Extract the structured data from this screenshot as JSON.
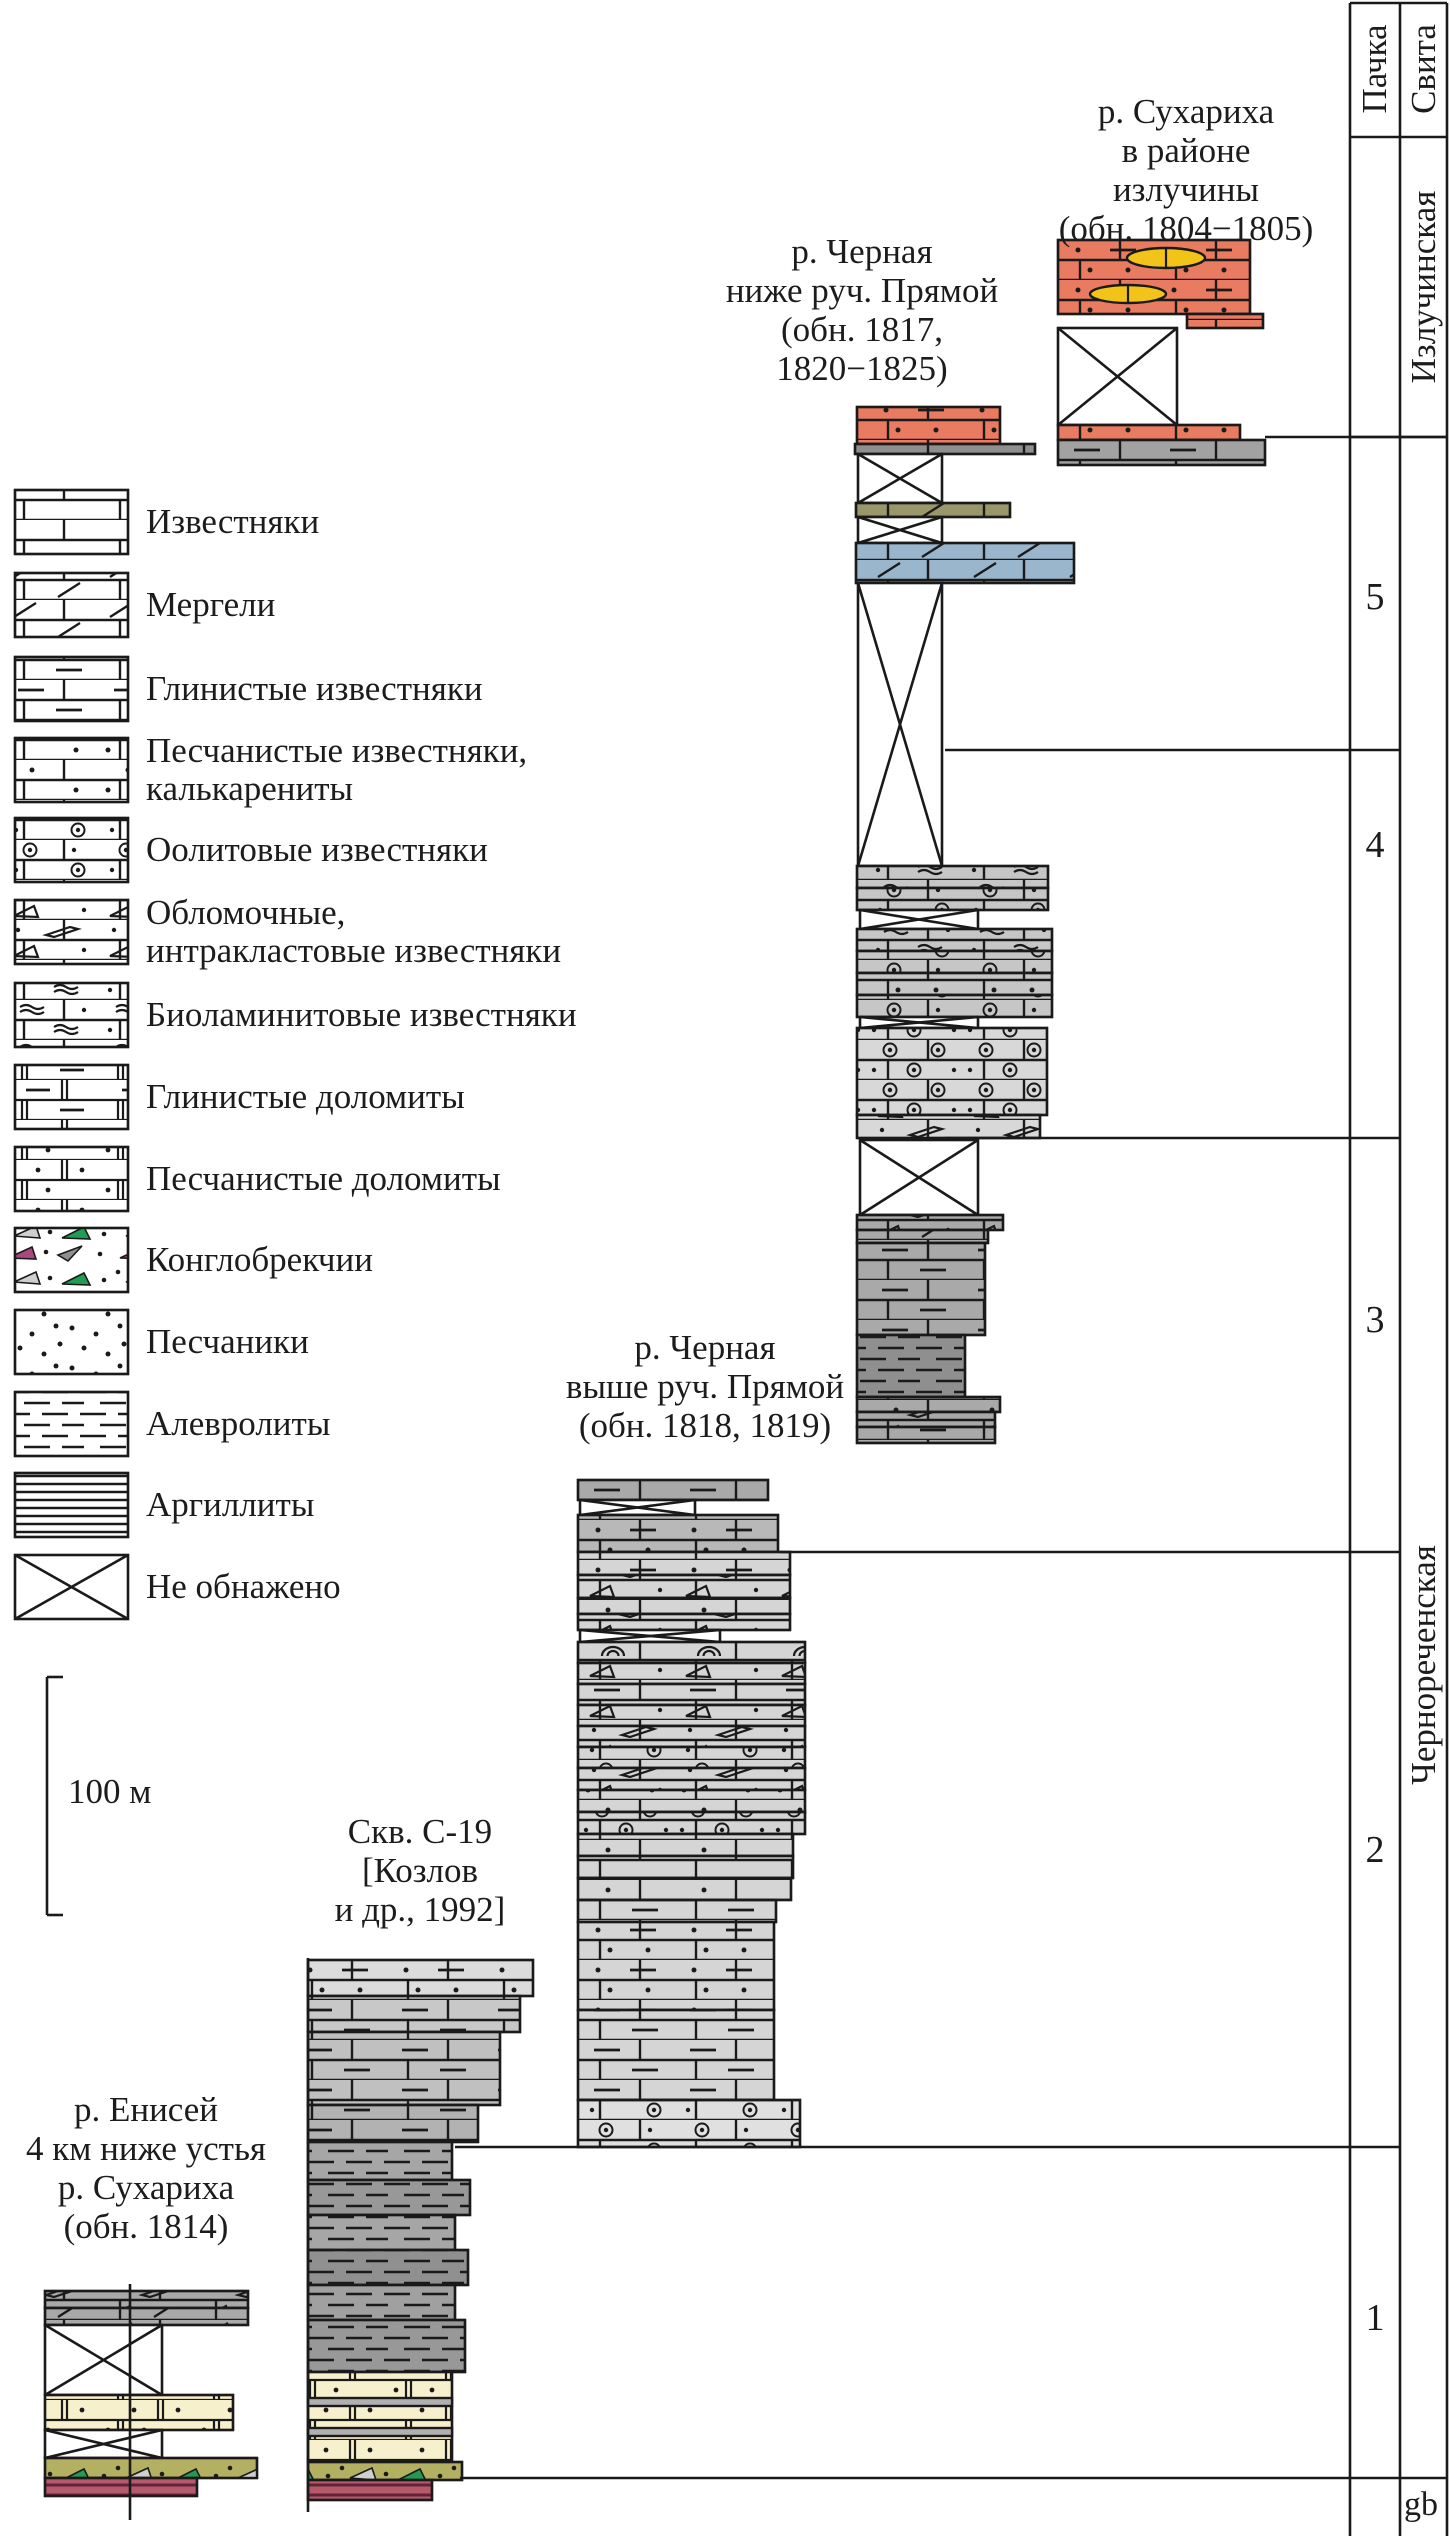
{
  "header": {
    "pachka": "Пачка",
    "svita": "Свита"
  },
  "formations": [
    {
      "name": "Излучинская",
      "cx": 1424,
      "cy": 287
    },
    {
      "name": "Чернореченская",
      "cx": 1424,
      "cy": 1665
    }
  ],
  "members": [
    {
      "label": "5",
      "cx": 1375,
      "cy": 597
    },
    {
      "label": "4",
      "cx": 1375,
      "cy": 845
    },
    {
      "label": "3",
      "cx": 1375,
      "cy": 1320
    },
    {
      "label": "2",
      "cx": 1375,
      "cy": 1850
    },
    {
      "label": "1",
      "cx": 1375,
      "cy": 2318
    }
  ],
  "footer": {
    "gb": "gb",
    "x": 1404,
    "y": 2486
  },
  "scalebar": {
    "label": "100 м",
    "label_x": 68,
    "label_y": 1772
  },
  "columns": [
    {
      "id": "enisey",
      "label": "р. Енисей\n4 км ниже устья\nр. Сухариха\n(обн. 1814)",
      "label_cx": 146,
      "label_top": 2090,
      "units": [
        {
          "x": 45,
          "y": 2291,
          "w": 203,
          "h": 17,
          "fill": "#a9a9a9",
          "pat": "brick-intra"
        },
        {
          "x": 45,
          "y": 2308,
          "w": 203,
          "h": 17,
          "fill": "#a9a9a9",
          "pat": "marl"
        },
        {
          "x": 45,
          "y": 2325,
          "w": 117,
          "h": 70,
          "type": "cross"
        },
        {
          "x": 45,
          "y": 2395,
          "w": 188,
          "h": 35,
          "fill": "#f7f0cc",
          "pat": "dolomite-dots"
        },
        {
          "x": 45,
          "y": 2430,
          "w": 117,
          "h": 28,
          "type": "cross"
        },
        {
          "x": 45,
          "y": 2458,
          "w": 212,
          "h": 20,
          "fill": "#b3b062",
          "pat": "conglo"
        },
        {
          "x": 45,
          "y": 2478,
          "w": 152,
          "h": 18,
          "fill": "#b55a6b",
          "pat": "crimson-lam"
        }
      ]
    },
    {
      "id": "skv-c19",
      "label": "Скв. С-19\n[Козлов\nи др., 1992]",
      "label_cx": 420,
      "label_top": 1812,
      "units": [
        {
          "x": 308,
          "y": 1960,
          "w": 225,
          "h": 36,
          "fill": "#dcdcdc",
          "pat": "brick-dotdash"
        },
        {
          "x": 308,
          "y": 1996,
          "w": 212,
          "h": 36,
          "fill": "#c8c8c8",
          "pat": "brick-dash"
        },
        {
          "x": 308,
          "y": 2032,
          "w": 192,
          "h": 73,
          "fill": "#c0c0c0",
          "pat": "brick-dash"
        },
        {
          "x": 308,
          "y": 2105,
          "w": 170,
          "h": 37,
          "fill": "#b2b2b2",
          "pat": "brick-dash"
        },
        {
          "x": 308,
          "y": 2142,
          "w": 144,
          "h": 38,
          "fill": "#a6a6a6",
          "pat": "silt"
        },
        {
          "x": 308,
          "y": 2180,
          "w": 162,
          "h": 35,
          "fill": "#989898",
          "pat": "silt"
        },
        {
          "x": 308,
          "y": 2215,
          "w": 147,
          "h": 35,
          "fill": "#a6a6a6",
          "pat": "silt"
        },
        {
          "x": 308,
          "y": 2250,
          "w": 160,
          "h": 35,
          "fill": "#909090",
          "pat": "silt"
        },
        {
          "x": 308,
          "y": 2285,
          "w": 147,
          "h": 35,
          "fill": "#a0a0a0",
          "pat": "silt"
        },
        {
          "x": 308,
          "y": 2320,
          "w": 157,
          "h": 52,
          "fill": "#989898",
          "pat": "silt"
        },
        {
          "x": 308,
          "y": 2372,
          "w": 144,
          "h": 90,
          "fill": "#f7f0cc",
          "pat": "dolomite-dots"
        },
        {
          "x": 308,
          "y": 2398,
          "w": 144,
          "h": 8,
          "fill": "#b0b0b0",
          "pat": "none"
        },
        {
          "x": 308,
          "y": 2428,
          "w": 144,
          "h": 8,
          "fill": "#b0b0b0",
          "pat": "none"
        },
        {
          "x": 308,
          "y": 2462,
          "w": 154,
          "h": 18,
          "fill": "#b3b062",
          "pat": "conglo"
        },
        {
          "x": 308,
          "y": 2480,
          "w": 124,
          "h": 20,
          "fill": "#b55a6b",
          "pat": "crimson-lam"
        }
      ]
    },
    {
      "id": "chernaya-vyshe",
      "label": "р. Черная\nвыше руч. Прямой\n(обн. 1818, 1819)",
      "label_cx": 705,
      "label_top": 1328,
      "units": [
        {
          "x": 578,
          "y": 1480,
          "w": 190,
          "h": 20,
          "fill": "#a9a9a9",
          "pat": "brick-dash"
        },
        {
          "x": 580,
          "y": 1500,
          "w": 115,
          "h": 15,
          "type": "cross"
        },
        {
          "x": 578,
          "y": 1515,
          "w": 200,
          "h": 37,
          "fill": "#b8b8b8",
          "pat": "brick-dotdash"
        },
        {
          "x": 578,
          "y": 1552,
          "w": 212,
          "h": 23,
          "fill": "#d5d5d5",
          "pat": "brick-dotdash"
        },
        {
          "x": 578,
          "y": 1575,
          "w": 212,
          "h": 23,
          "fill": "#d5d5d5",
          "pat": "brick-intra"
        },
        {
          "x": 578,
          "y": 1598,
          "w": 212,
          "h": 16,
          "fill": "#d5d5d5",
          "pat": "brick-dots"
        },
        {
          "x": 578,
          "y": 1614,
          "w": 212,
          "h": 16,
          "fill": "#d5d5d5",
          "pat": "brick-intra"
        },
        {
          "x": 580,
          "y": 1630,
          "w": 140,
          "h": 12,
          "type": "cross"
        },
        {
          "x": 578,
          "y": 1642,
          "w": 227,
          "h": 21,
          "fill": "#d5d5d5",
          "pat": "brick-arc"
        },
        {
          "x": 578,
          "y": 1663,
          "w": 227,
          "h": 21,
          "fill": "#d5d5d5",
          "pat": "brick-intra"
        },
        {
          "x": 578,
          "y": 1684,
          "w": 227,
          "h": 21,
          "fill": "#d5d5d5",
          "pat": "brick-dash"
        },
        {
          "x": 578,
          "y": 1705,
          "w": 227,
          "h": 21,
          "fill": "#d5d5d5",
          "pat": "brick-intra"
        },
        {
          "x": 578,
          "y": 1726,
          "w": 227,
          "h": 21,
          "fill": "#d5d5d5",
          "pat": "brick-intra"
        },
        {
          "x": 578,
          "y": 1747,
          "w": 227,
          "h": 21,
          "fill": "#d5d5d5",
          "pat": "brick-oolite"
        },
        {
          "x": 578,
          "y": 1768,
          "w": 227,
          "h": 22,
          "fill": "#d5d5d5",
          "pat": "brick-intra"
        },
        {
          "x": 578,
          "y": 1790,
          "w": 227,
          "h": 22,
          "fill": "#d5d5d5",
          "pat": "brick-dots"
        },
        {
          "x": 578,
          "y": 1812,
          "w": 227,
          "h": 22,
          "fill": "#d5d5d5",
          "pat": "brick-oolite-rich"
        },
        {
          "x": 578,
          "y": 1834,
          "w": 215,
          "h": 22,
          "fill": "#d5d5d5",
          "pat": "brick-dots"
        },
        {
          "x": 578,
          "y": 1856,
          "w": 215,
          "h": 22,
          "fill": "#d5d5d5",
          "pat": "brick"
        },
        {
          "x": 578,
          "y": 1878,
          "w": 213,
          "h": 22,
          "fill": "#d5d5d5",
          "pat": "brick-dots"
        },
        {
          "x": 578,
          "y": 1900,
          "w": 198,
          "h": 22,
          "fill": "#d5d5d5",
          "pat": "brick-dash"
        },
        {
          "x": 578,
          "y": 1922,
          "w": 196,
          "h": 88,
          "fill": "#d5d5d5",
          "pat": "brick-dotdash"
        },
        {
          "x": 578,
          "y": 2010,
          "w": 196,
          "h": 90,
          "fill": "#d5d5d5",
          "pat": "brick-dash"
        },
        {
          "x": 578,
          "y": 2100,
          "w": 222,
          "h": 47,
          "fill": "#e0e0e0",
          "pat": "brick-oolite"
        }
      ]
    },
    {
      "id": "chernaya-nizhe",
      "label": "р. Черная\nниже руч. Прямой\n(обн. 1817,\n1820−1825)",
      "label_cx": 862,
      "label_top": 232,
      "units": [
        {
          "x": 857,
          "y": 407,
          "w": 143,
          "h": 37,
          "fill": "#e87b60",
          "pat": "brick-dotdash"
        },
        {
          "x": 855,
          "y": 444,
          "w": 180,
          "h": 10,
          "fill": "#8f8f8f",
          "pat": "brick"
        },
        {
          "x": 858,
          "y": 454,
          "w": 84,
          "h": 49,
          "type": "cross"
        },
        {
          "x": 856,
          "y": 503,
          "w": 154,
          "h": 14,
          "fill": "#9a976b",
          "pat": "marl"
        },
        {
          "x": 858,
          "y": 517,
          "w": 84,
          "h": 26,
          "type": "cross"
        },
        {
          "x": 856,
          "y": 543,
          "w": 218,
          "h": 40,
          "fill": "#9ab6cd",
          "pat": "marl"
        },
        {
          "x": 858,
          "y": 583,
          "w": 84,
          "h": 283,
          "type": "cross"
        },
        {
          "x": 857,
          "y": 866,
          "w": 191,
          "h": 22,
          "fill": "#c6c6c6",
          "pat": "brick-biolam"
        },
        {
          "x": 857,
          "y": 888,
          "w": 191,
          "h": 22,
          "fill": "#c6c6c6",
          "pat": "brick-oolite"
        },
        {
          "x": 860,
          "y": 910,
          "w": 118,
          "h": 19,
          "type": "cross"
        },
        {
          "x": 857,
          "y": 929,
          "w": 195,
          "h": 22,
          "fill": "#c6c6c6",
          "pat": "brick-biolam"
        },
        {
          "x": 857,
          "y": 951,
          "w": 195,
          "h": 22,
          "fill": "#c6c6c6",
          "pat": "brick-oolite"
        },
        {
          "x": 857,
          "y": 973,
          "w": 195,
          "h": 22,
          "fill": "#c6c6c6",
          "pat": "brick-dotdash"
        },
        {
          "x": 857,
          "y": 995,
          "w": 195,
          "h": 22,
          "fill": "#c6c6c6",
          "pat": "brick-oolite"
        },
        {
          "x": 860,
          "y": 1017,
          "w": 118,
          "h": 11,
          "type": "cross"
        },
        {
          "x": 857,
          "y": 1028,
          "w": 190,
          "h": 87,
          "fill": "#d8d8d8",
          "pat": "brick-oolite-rich"
        },
        {
          "x": 857,
          "y": 1115,
          "w": 183,
          "h": 23,
          "fill": "#d8d8d8",
          "pat": "brick-intra"
        },
        {
          "x": 860,
          "y": 1140,
          "w": 118,
          "h": 75,
          "type": "cross"
        },
        {
          "x": 857,
          "y": 1215,
          "w": 146,
          "h": 15,
          "fill": "#a9a9a9",
          "pat": "brick-intra"
        },
        {
          "x": 857,
          "y": 1230,
          "w": 131,
          "h": 13,
          "fill": "#a9a9a9",
          "pat": "marl"
        },
        {
          "x": 857,
          "y": 1243,
          "w": 128,
          "h": 92,
          "fill": "#a9a9a9",
          "pat": "brick-dash"
        },
        {
          "x": 857,
          "y": 1335,
          "w": 108,
          "h": 62,
          "fill": "#8f8f8f",
          "pat": "silt"
        },
        {
          "x": 857,
          "y": 1397,
          "w": 143,
          "h": 15,
          "fill": "#a9a9a9",
          "pat": "brick-dots"
        },
        {
          "x": 857,
          "y": 1412,
          "w": 138,
          "h": 15,
          "fill": "#a9a9a9",
          "pat": "brick-intra"
        },
        {
          "x": 857,
          "y": 1427,
          "w": 138,
          "h": 16,
          "fill": "#a9a9a9",
          "pat": "brick-dash"
        }
      ]
    },
    {
      "id": "sukhariha-izluchina",
      "label": "р. Сухариха\nв районе излучины\n(обн. 1804−1805)",
      "label_cx": 1186,
      "label_top": 92,
      "units": [
        {
          "x": 1058,
          "y": 240,
          "w": 192,
          "h": 74,
          "fill": "#e87b60",
          "pat": "brick-dotdash"
        },
        {
          "x": 1187,
          "y": 314,
          "w": 76,
          "h": 14,
          "fill": "#e87b60",
          "pat": "brick-dots"
        },
        {
          "x": 1058,
          "y": 328,
          "w": 119,
          "h": 97,
          "type": "cross"
        },
        {
          "x": 1058,
          "y": 425,
          "w": 182,
          "h": 15,
          "fill": "#e87b60",
          "pat": "brick-dotdash"
        },
        {
          "x": 1058,
          "y": 440,
          "w": 207,
          "h": 25,
          "fill": "#a2a2a2",
          "pat": "brick-dash"
        }
      ]
    }
  ],
  "oncolites": [
    {
      "cx": 1166,
      "cy": 258,
      "rx": 39,
      "ry": 10,
      "fill": "#f2c41a"
    },
    {
      "cx": 1128,
      "cy": 294,
      "rx": 38,
      "ry": 9,
      "fill": "#f2c41a"
    }
  ],
  "lines": [
    {
      "x1": 1265,
      "y1": 437,
      "x2": 1447,
      "y2": 437
    },
    {
      "x1": 945,
      "y1": 750,
      "x2": 1400,
      "y2": 750
    },
    {
      "x1": 945,
      "y1": 1138,
      "x2": 1400,
      "y2": 1138
    },
    {
      "x1": 780,
      "y1": 1552,
      "x2": 1400,
      "y2": 1552
    },
    {
      "x1": 455,
      "y1": 2147,
      "x2": 1400,
      "y2": 2147
    },
    {
      "x1": 460,
      "y1": 2478,
      "x2": 1447,
      "y2": 2478
    },
    {
      "x1": 1350,
      "y1": 3,
      "x2": 1350,
      "y2": 2536
    },
    {
      "x1": 1400,
      "y1": 3,
      "x2": 1400,
      "y2": 2536
    },
    {
      "x1": 1447,
      "y1": 3,
      "x2": 1447,
      "y2": 2536
    },
    {
      "x1": 1350,
      "y1": 3,
      "x2": 1447,
      "y2": 3
    },
    {
      "x1": 1350,
      "y1": 137,
      "x2": 1447,
      "y2": 137
    },
    {
      "x1": 1350,
      "y1": 437,
      "x2": 1447,
      "y2": 437
    },
    {
      "x1": 130,
      "y1": 2284,
      "x2": 130,
      "y2": 2520
    },
    {
      "x1": 308,
      "y1": 1958,
      "x2": 308,
      "y2": 2512
    },
    {
      "x1": 47,
      "y1": 1677,
      "x2": 47,
      "y2": 1915
    },
    {
      "x1": 47,
      "y1": 1677,
      "x2": 63,
      "y2": 1677
    },
    {
      "x1": 47,
      "y1": 1915,
      "x2": 63,
      "y2": 1915
    }
  ],
  "legend": {
    "swatch": {
      "x": 15,
      "w": 113,
      "h": 64
    },
    "items": [
      {
        "y": 490,
        "label": "Известняки",
        "pat": "brick"
      },
      {
        "y": 573,
        "label": "Мергели",
        "pat": "marl"
      },
      {
        "y": 657,
        "label": "Глинистые известняки",
        "pat": "brick-dash"
      },
      {
        "y": 738,
        "label": "Песчанистые известняки,\nкалькарениты",
        "pat": "brick-dots"
      },
      {
        "y": 818,
        "label": "Оолитовые известняки",
        "pat": "brick-oolite"
      },
      {
        "y": 900,
        "label": "Обломочные,\nинтракластовые известняки",
        "pat": "brick-intra"
      },
      {
        "y": 983,
        "label": "Биоламинитовые известняки",
        "pat": "brick-biolam"
      },
      {
        "y": 1065,
        "label": "Глинистые доломиты",
        "pat": "dolomite-dash"
      },
      {
        "y": 1147,
        "label": "Песчанистые доломиты",
        "pat": "dolomite-dots"
      },
      {
        "y": 1228,
        "label": "Конглобрекчии",
        "pat": "conglo"
      },
      {
        "y": 1310,
        "label": "Песчаники",
        "pat": "sand"
      },
      {
        "y": 1392,
        "label": "Алевролиты",
        "pat": "silt"
      },
      {
        "y": 1473,
        "label": "Аргиллиты",
        "pat": "argillite"
      },
      {
        "y": 1555,
        "label": "Не обнажено",
        "type": "cross"
      }
    ]
  },
  "colors": {
    "ink": "#1a1a1a",
    "red_unit": "#e87b60",
    "blue_marl": "#9ab6cd",
    "olive": "#9a976b",
    "conglo_matrix": "#b3b062",
    "crimson": "#b55a6b",
    "dolomite": "#f7f0cc",
    "oncolite_yellow": "#f2c41a"
  }
}
